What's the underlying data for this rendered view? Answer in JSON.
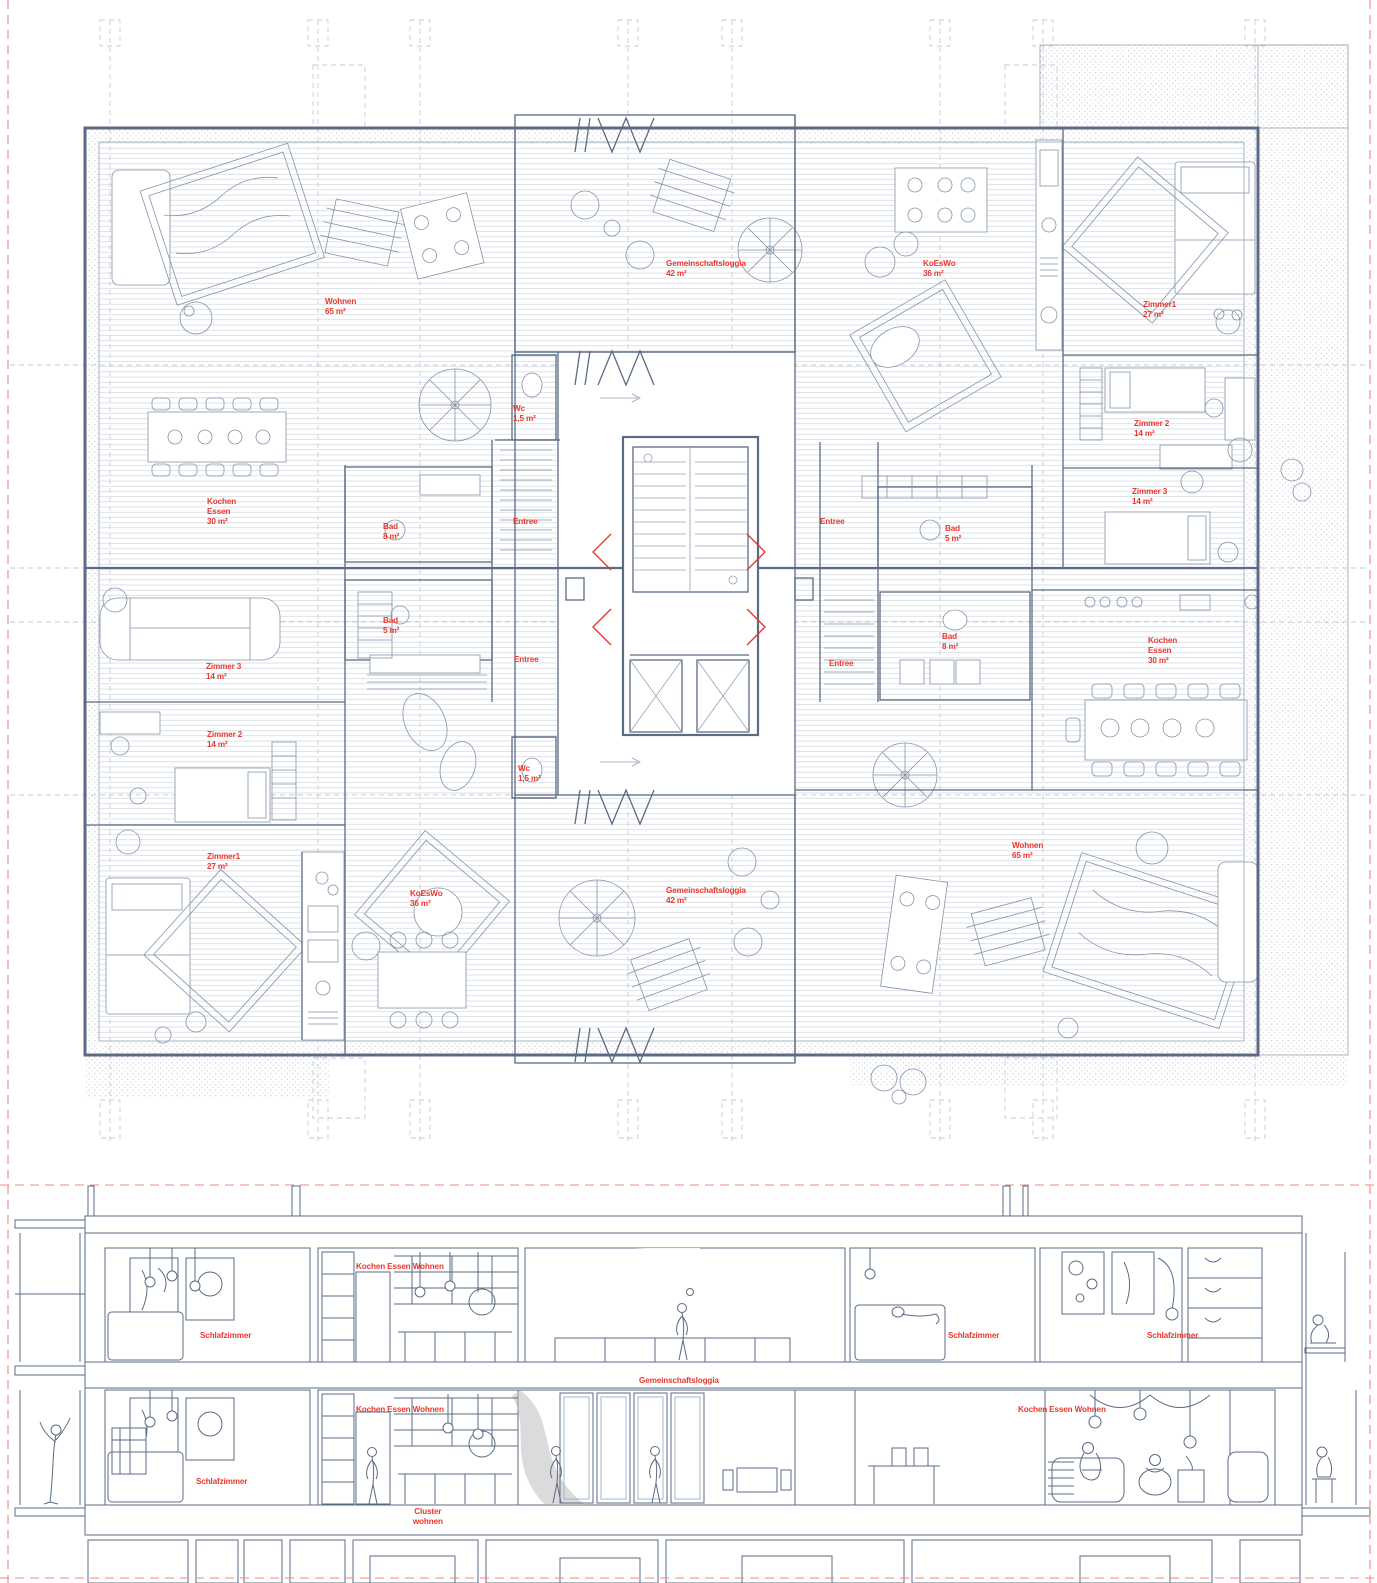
{
  "drawing": {
    "kind": "architectural floor plan with building section",
    "language": "German"
  },
  "colors": {
    "label_red": "#e8382d",
    "line_slate": "#5b6b84",
    "line_light": "#97a5b8",
    "hatch": "#cdd5de",
    "tile": "#b8c2cf",
    "stipple": "#c9ced6",
    "wood_line": "#a3a3a3",
    "wood_bg": "#ededed",
    "slab_fill": "#e7eaee",
    "guide_red": "#f08a80"
  },
  "plan": {
    "labels": [
      {
        "id": "wohnen-top-left",
        "text": "Wohnen\n65 m²",
        "x": 325,
        "y": 296
      },
      {
        "id": "gemeinschaftsloggia-top",
        "text": "Gemeinschaftsloggia\n42 m²",
        "x": 666,
        "y": 258
      },
      {
        "id": "koeswo-top-right",
        "text": "KoEsWo\n36 m²",
        "x": 923,
        "y": 258
      },
      {
        "id": "zimmer1-top-right",
        "text": "Zimmer1\n27 m²",
        "x": 1143,
        "y": 299
      },
      {
        "id": "wc-top",
        "text": "Wc\n1,5 m²",
        "x": 513,
        "y": 403
      },
      {
        "id": "zimmer2-right",
        "text": "Zimmer 2\n14 m²",
        "x": 1134,
        "y": 418
      },
      {
        "id": "kochen-essen-left",
        "text": "Kochen\nEssen\n30 m²",
        "x": 207,
        "y": 496
      },
      {
        "id": "bad-8-left",
        "text": "Bad\n8 m²",
        "x": 383,
        "y": 521
      },
      {
        "id": "entree-left-upper",
        "text": "Entree",
        "x": 513,
        "y": 516
      },
      {
        "id": "entree-right-upper",
        "text": "Entree",
        "x": 820,
        "y": 516
      },
      {
        "id": "bad-5-right",
        "text": "Bad\n5 m²",
        "x": 945,
        "y": 523
      },
      {
        "id": "zimmer3-right",
        "text": "Zimmer 3\n14 m²",
        "x": 1132,
        "y": 486
      },
      {
        "id": "bad-5-left",
        "text": "Bad\n5 m²",
        "x": 383,
        "y": 615
      },
      {
        "id": "zimmer3-left",
        "text": "Zimmer 3\n14 m²",
        "x": 206,
        "y": 661
      },
      {
        "id": "entree-left-lower",
        "text": "Entree",
        "x": 514,
        "y": 654
      },
      {
        "id": "entree-right-lower",
        "text": "Entree",
        "x": 829,
        "y": 658
      },
      {
        "id": "bad-8-right",
        "text": "Bad\n8 m²",
        "x": 942,
        "y": 631
      },
      {
        "id": "kochen-essen-right",
        "text": "Kochen\nEssen\n30 m²",
        "x": 1148,
        "y": 635
      },
      {
        "id": "zimmer2-left",
        "text": "Zimmer 2\n14 m²",
        "x": 207,
        "y": 729
      },
      {
        "id": "wc-bottom",
        "text": "Wc\n1,5 m²",
        "x": 518,
        "y": 763
      },
      {
        "id": "zimmer1-bottom-left",
        "text": "Zimmer1\n27 m²",
        "x": 207,
        "y": 851
      },
      {
        "id": "koeswo-bottom-left",
        "text": "KoEsWo\n36 m²",
        "x": 410,
        "y": 888
      },
      {
        "id": "gemeinschaftsloggia-bottom",
        "text": "Gemeinschaftsloggia\n42 m²",
        "x": 666,
        "y": 885
      },
      {
        "id": "wohnen-bottom-right",
        "text": "Wohnen\n65 m²",
        "x": 1012,
        "y": 840
      }
    ]
  },
  "section": {
    "labels": [
      {
        "id": "kochen-essen-wohnen-upper",
        "text": "Kochen Essen Wohnen",
        "x": 356,
        "y": 1261
      },
      {
        "id": "schlafzimmer-upper-left",
        "text": "Schlafzimmer",
        "x": 200,
        "y": 1330
      },
      {
        "id": "schlafzimmer-upper-right-1",
        "text": "Schlafzimmer",
        "x": 948,
        "y": 1330
      },
      {
        "id": "schlafzimmer-upper-right-2",
        "text": "Schlafzimmer",
        "x": 1147,
        "y": 1330
      },
      {
        "id": "gemeinschaftsloggia-section",
        "text": "Gemeinschaftsloggia",
        "x": 639,
        "y": 1375
      },
      {
        "id": "kochen-essen-wohnen-lower-left",
        "text": "Kochen Essen Wohnen",
        "x": 356,
        "y": 1404
      },
      {
        "id": "schlafzimmer-lower-left",
        "text": "Schlafzimmer",
        "x": 196,
        "y": 1476
      },
      {
        "id": "kochen-essen-wohnen-lower-right",
        "text": "Kochen Essen Wohnen",
        "x": 1018,
        "y": 1404
      },
      {
        "id": "cluster-wohnen",
        "text": "Cluster\nwohnen",
        "x": 400,
        "y": 1506,
        "align": "center"
      }
    ]
  }
}
